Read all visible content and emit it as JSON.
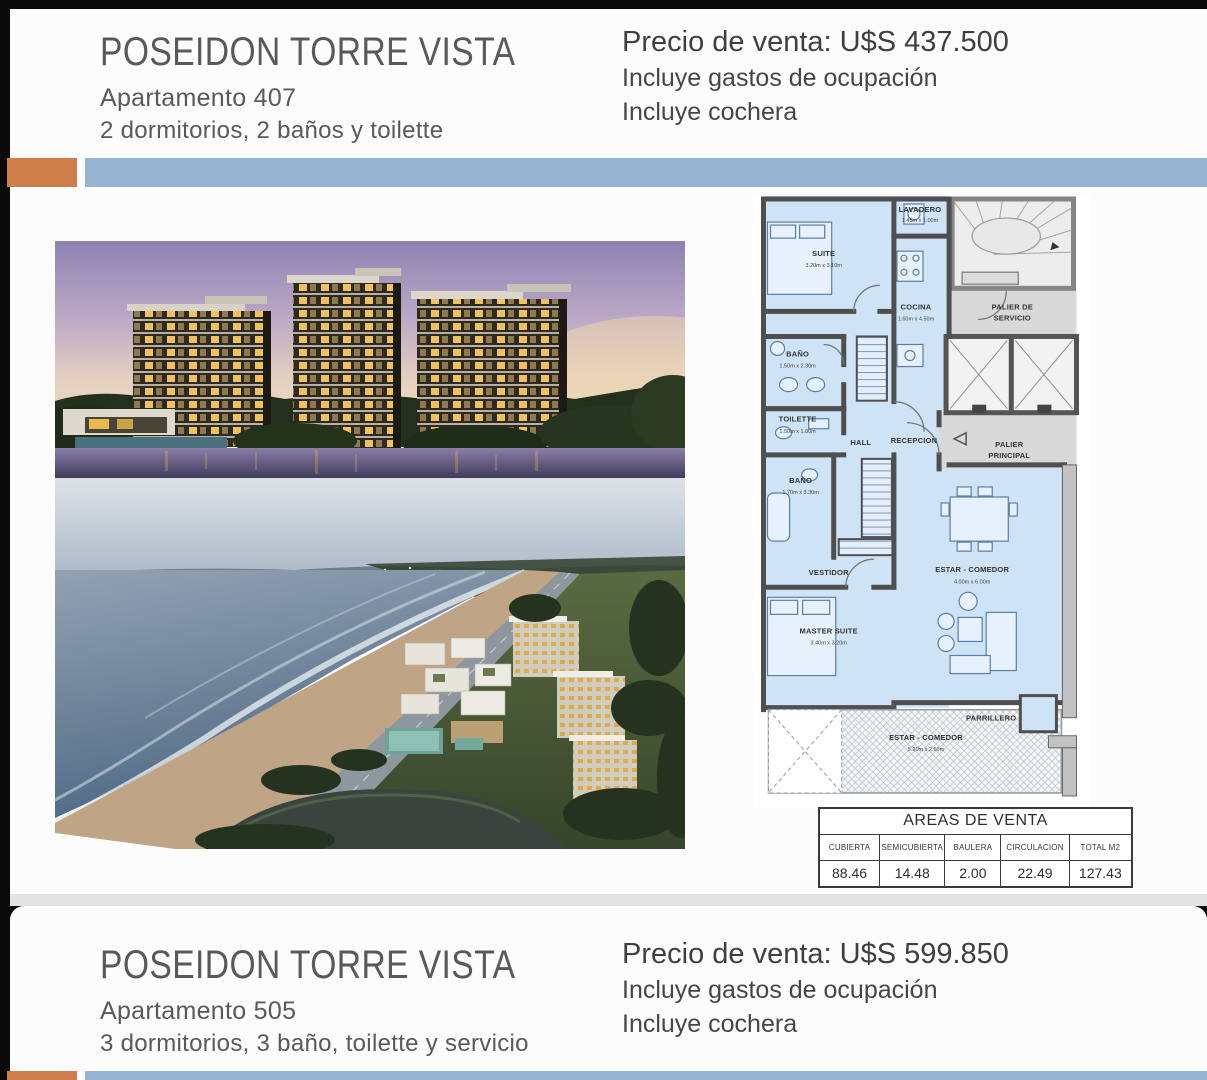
{
  "slide1": {
    "title": "POSEIDON TORRE VISTA",
    "apartment": "Apartamento 407",
    "features": "2 dormitorios, 2 baños y toilette",
    "price": "Precio de venta: U$S 437.500",
    "note_occupation": "Incluye gastos de ocupación",
    "note_garage": "Incluye cochera"
  },
  "slide2": {
    "title": "POSEIDON TORRE VISTA",
    "apartment": "Apartamento 505",
    "features": "3 dormitorios, 3 baño, toilette y servicio",
    "price": "Precio de venta: U$S 599.850",
    "note_occupation": "Incluye gastos de ocupación",
    "note_garage": "Incluye cochera"
  },
  "floorplan": {
    "rooms": {
      "suite": {
        "name": "SUITE",
        "dims": "3.20m x 3.10m"
      },
      "lavadero": {
        "name": "LAVADERO",
        "dims": "1.45m x 1.00m"
      },
      "cocina": {
        "name": "COCINA",
        "dims": "1.60m x 4.50m"
      },
      "palier_servicio": {
        "line1": "PALIER DE",
        "line2": "SERVICIO"
      },
      "bano1": {
        "name": "BAÑO",
        "dims": "1.50m x 2.30m"
      },
      "toilette": {
        "name": "TOILETTE",
        "dims": "1.50m x 1.00m"
      },
      "hall": {
        "name": "HALL"
      },
      "recepcion": {
        "name": "RECEPCION"
      },
      "palier_principal": {
        "line1": "PALIER",
        "line2": "PRINCIPAL"
      },
      "bano2": {
        "name": "BAÑO",
        "dims": "1.70m x 3.30m"
      },
      "vestidor": {
        "name": "VESTIDOR"
      },
      "estar_comedor": {
        "name": "ESTAR - COMEDOR",
        "dims": "4.00m x 6.00m"
      },
      "master_suite": {
        "name": "MASTER SUITE",
        "dims": "3.40m x 3.20m"
      },
      "parrillero": {
        "name": "PARRILLERO"
      },
      "terraza": {
        "name": "ESTAR - COMEDOR",
        "dims": "5.20m x 2.50m"
      }
    }
  },
  "areas_table": {
    "title": "AREAS DE VENTA",
    "headers": [
      "CUBIERTA",
      "SEMICUBIERTA",
      "BAULERA",
      "CIRCULACION",
      "TOTAL M2"
    ],
    "values": [
      "88.46",
      "14.48",
      "2.00",
      "22.49",
      "127.43"
    ]
  },
  "colors": {
    "accent_orange": "#cd7e4b",
    "accent_blue": "#95b5d3",
    "plan_room_fill": "#cfe3f6",
    "title_gray": "#58595b"
  }
}
